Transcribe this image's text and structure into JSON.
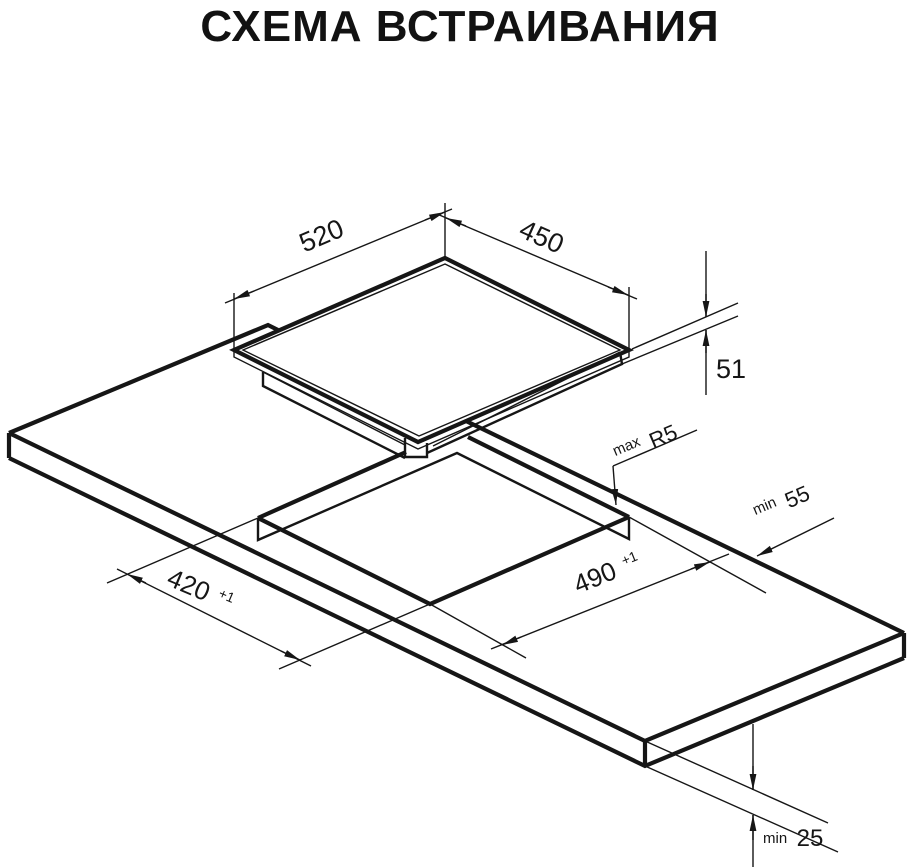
{
  "title": "СХЕМА ВСТРАИВАНИЯ",
  "colors": {
    "line": "#161616",
    "background": "#ffffff"
  },
  "dimensions": {
    "top_width": {
      "value": "520"
    },
    "top_depth": {
      "value": "450"
    },
    "hob_height": {
      "value": "51"
    },
    "cutout_radius": {
      "prefix": "max",
      "value": "R5"
    },
    "rear_clearance": {
      "prefix": "min",
      "value": "55"
    },
    "cutout_length": {
      "value": "490",
      "tolerance": "+1"
    },
    "cutout_width": {
      "value": "420",
      "tolerance": "+1"
    },
    "worktop_thickness": {
      "prefix": "min",
      "value": "25"
    }
  }
}
